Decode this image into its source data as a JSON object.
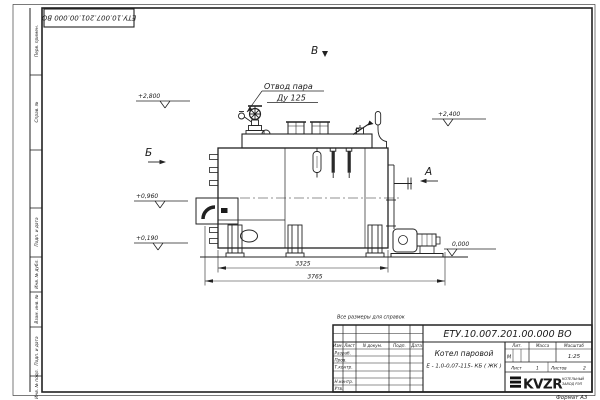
{
  "top_stamp": {
    "designation": "ЕТУ.10.007.201.00.000  ВО"
  },
  "frame": {
    "side_top": [
      "Перв. примен.",
      "Справ. №"
    ],
    "side_bottom": [
      "Подп. и дата",
      "Инв. № дубл.",
      "Взам. инв. №",
      "Подп. и дата",
      "Инв. № подл."
    ],
    "format_note": "Формат А3"
  },
  "drawing": {
    "callout": {
      "line1": "Отвод пара",
      "line2": "Ду 125"
    },
    "views": {
      "top": "В",
      "left": "Б",
      "right": "А"
    },
    "elevations": {
      "e1": "+2,800",
      "e2": "+2,400",
      "e3": "+0,960",
      "e4": "+0,190",
      "e5": "0,000"
    },
    "dims": {
      "inner": "3325",
      "outer": "3765"
    }
  },
  "note": "Все размеры для справок",
  "title_block": {
    "designation": "ЕТУ.10.007.201.00.000  ВО",
    "name1": "Котел паровой",
    "name2": "Е - 1,0-0,07-115- КБ ( ЖК )",
    "cols": {
      "izm": "Изм.",
      "list": "Лист",
      "ndoc": "N докум.",
      "podp": "Подп.",
      "data": "Дата"
    },
    "rows": {
      "razrab": "Разраб.",
      "prov": "Пров.",
      "tkontr": "Т.контр.",
      "nkontr": "Н.контр.",
      "utv": "Утв."
    },
    "lit": {
      "header": "Лит.",
      "value": "М"
    },
    "mass_header": "Масса",
    "scale": {
      "header": "Масштаб",
      "value": "1:25"
    },
    "sheet": {
      "label": "Лист",
      "value": "1"
    },
    "sheets": {
      "label": "Листов",
      "value": "2"
    },
    "logo": {
      "text": "KVZR",
      "sub1": "КОТЕЛЬНЫЙ",
      "sub2": "ЗАВОД РЭП"
    }
  }
}
